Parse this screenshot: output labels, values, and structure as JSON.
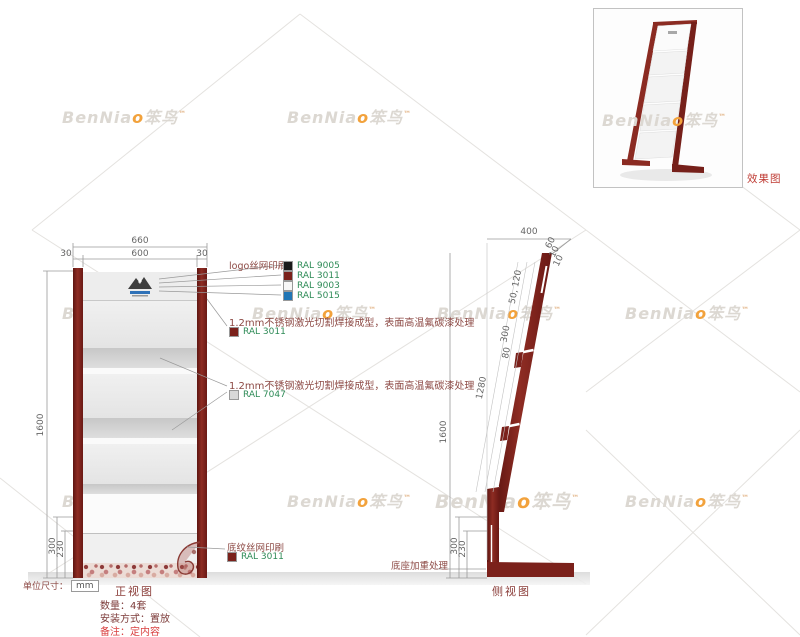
{
  "watermark": {
    "brand": "BenNia",
    "accent_letter": "o",
    "cn_name": "笨鸟",
    "mark": "™",
    "color": "#dcd8d2",
    "accent_color": "#f2a23c"
  },
  "effect_panel": {
    "caption": "效果图"
  },
  "front_view": {
    "title": "正视图",
    "dims": {
      "overall_width": "660",
      "inner_width": "600",
      "left_margin": "30",
      "right_margin": "30",
      "total_height": "1600",
      "base_height": "300",
      "pattern_height": "230"
    },
    "unit_prefix": "单位尺寸：",
    "unit_value": "mm"
  },
  "side_view": {
    "title": "侧视图",
    "dims": {
      "base_depth": "400",
      "top_cap": "60",
      "gap1": "10",
      "gap2": "10",
      "shelf_span": "50, 120",
      "segment": "300",
      "bracket": "80",
      "rail_length": "1280",
      "total_height": "1600",
      "base_height": "300",
      "pattern_height": "230"
    },
    "base_note": "底座加重处理"
  },
  "annotations": {
    "logo_print": {
      "label": "logo丝网印刷",
      "colors": [
        {
          "code": "RAL 9005",
          "hex": "#1a1a1a"
        },
        {
          "code": "RAL 3011",
          "hex": "#7b211b"
        },
        {
          "code": "RAL 9003",
          "hex": "#f7f7f7"
        },
        {
          "code": "RAL 5015",
          "hex": "#2176b5"
        }
      ]
    },
    "steel_main": {
      "label": "1.2mm不锈钢激光切割焊接成型，表面高温氟碳漆处理",
      "color": {
        "code": "RAL 3011",
        "hex": "#7b211b"
      }
    },
    "steel_panel": {
      "label": "1.2mm不锈钢激光切割焊接成型，表面高温氟碳漆处理",
      "color": {
        "code": "RAL 7047",
        "hex": "#d8d8d8"
      }
    },
    "pattern_print": {
      "label": "底纹丝网印刷",
      "color": {
        "code": "RAL 3011",
        "hex": "#7b211b"
      }
    }
  },
  "order_notes": {
    "quantity": "数量：4套",
    "install": "安装方式：置放",
    "remark": "备注：定内容"
  },
  "palette": {
    "rail": "#7b211b",
    "panel_light": "#e9e9e9",
    "shelf_lip": "#cfcfcf",
    "annotation_text": "#8d4a45",
    "ral_text": "#2e8b57",
    "remark_red": "#d94040",
    "caption_red": "#bf3a32",
    "dim_text": "#666666"
  }
}
